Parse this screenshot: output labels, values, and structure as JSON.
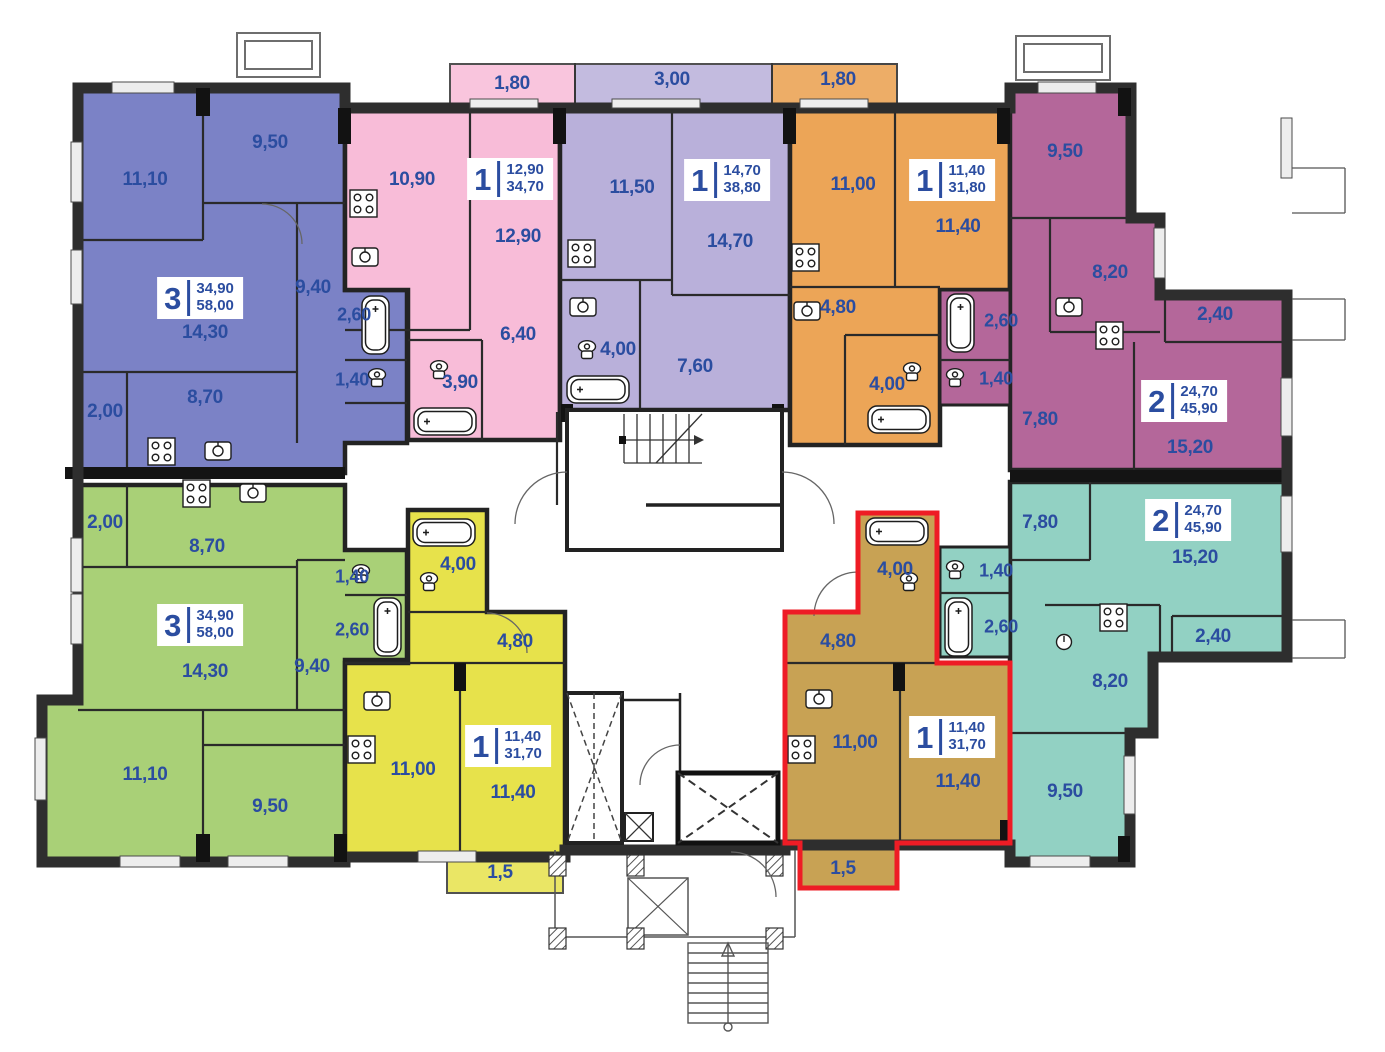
{
  "plan": {
    "highlight_color": "#ee1c25",
    "label_color": "#2b4da0",
    "apartments": [
      {
        "id": "blue-3-room",
        "color": "#7b82c6",
        "badge": {
          "rooms": "3",
          "living_area": "34,90",
          "total_area": "58,00"
        },
        "rooms": [
          "11,10",
          "9,50",
          "14,30",
          "9,40",
          "8,70",
          "2,00",
          "2,60",
          "1,40"
        ]
      },
      {
        "id": "pink-1-room",
        "color": "#f8bcd8",
        "balcony": "1,80",
        "badge": {
          "rooms": "1",
          "living_area": "12,90",
          "total_area": "34,70"
        },
        "rooms": [
          "10,90",
          "12,90",
          "6,40",
          "3,90"
        ]
      },
      {
        "id": "lavender-1-room",
        "color": "#b9b0da",
        "balcony": "3,00",
        "badge": {
          "rooms": "1",
          "living_area": "14,70",
          "total_area": "38,80"
        },
        "rooms": [
          "11,50",
          "14,70",
          "4,00",
          "7,60"
        ]
      },
      {
        "id": "orange-1-room",
        "color": "#eca557",
        "balcony": "1,80",
        "badge": {
          "rooms": "1",
          "living_area": "11,40",
          "total_area": "31,80"
        },
        "rooms": [
          "11,00",
          "11,40",
          "4,80",
          "4,00"
        ]
      },
      {
        "id": "maroon-2-room",
        "color": "#b4679a",
        "balcony": "2,40",
        "badge": {
          "rooms": "2",
          "living_area": "24,70",
          "total_area": "45,90"
        },
        "rooms": [
          "9,50",
          "8,20",
          "7,80",
          "15,20",
          "2,60",
          "1,40"
        ]
      },
      {
        "id": "green-3-room",
        "color": "#a9d077",
        "badge": {
          "rooms": "3",
          "living_area": "34,90",
          "total_area": "58,00"
        },
        "rooms": [
          "2,00",
          "8,70",
          "14,30",
          "9,40",
          "11,10",
          "9,50",
          "1,40",
          "2,60"
        ]
      },
      {
        "id": "yellow-1-room",
        "color": "#e7e24b",
        "balcony": "1,5",
        "badge": {
          "rooms": "1",
          "living_area": "11,40",
          "total_area": "31,70"
        },
        "rooms": [
          "4,00",
          "4,80",
          "11,00",
          "11,40"
        ]
      },
      {
        "id": "tan-1-room-selected",
        "color": "#c8a254",
        "balcony": "1,5",
        "badge": {
          "rooms": "1",
          "living_area": "11,40",
          "total_area": "31,70"
        },
        "rooms": [
          "4,00",
          "4,80",
          "11,00",
          "11,40"
        ]
      },
      {
        "id": "teal-2-room",
        "color": "#92d1c3",
        "balcony": "2,40",
        "badge": {
          "rooms": "2",
          "living_area": "24,70",
          "total_area": "45,90"
        },
        "rooms": [
          "7,80",
          "15,20",
          "8,20",
          "9,50",
          "1,40",
          "2,60"
        ]
      }
    ]
  }
}
